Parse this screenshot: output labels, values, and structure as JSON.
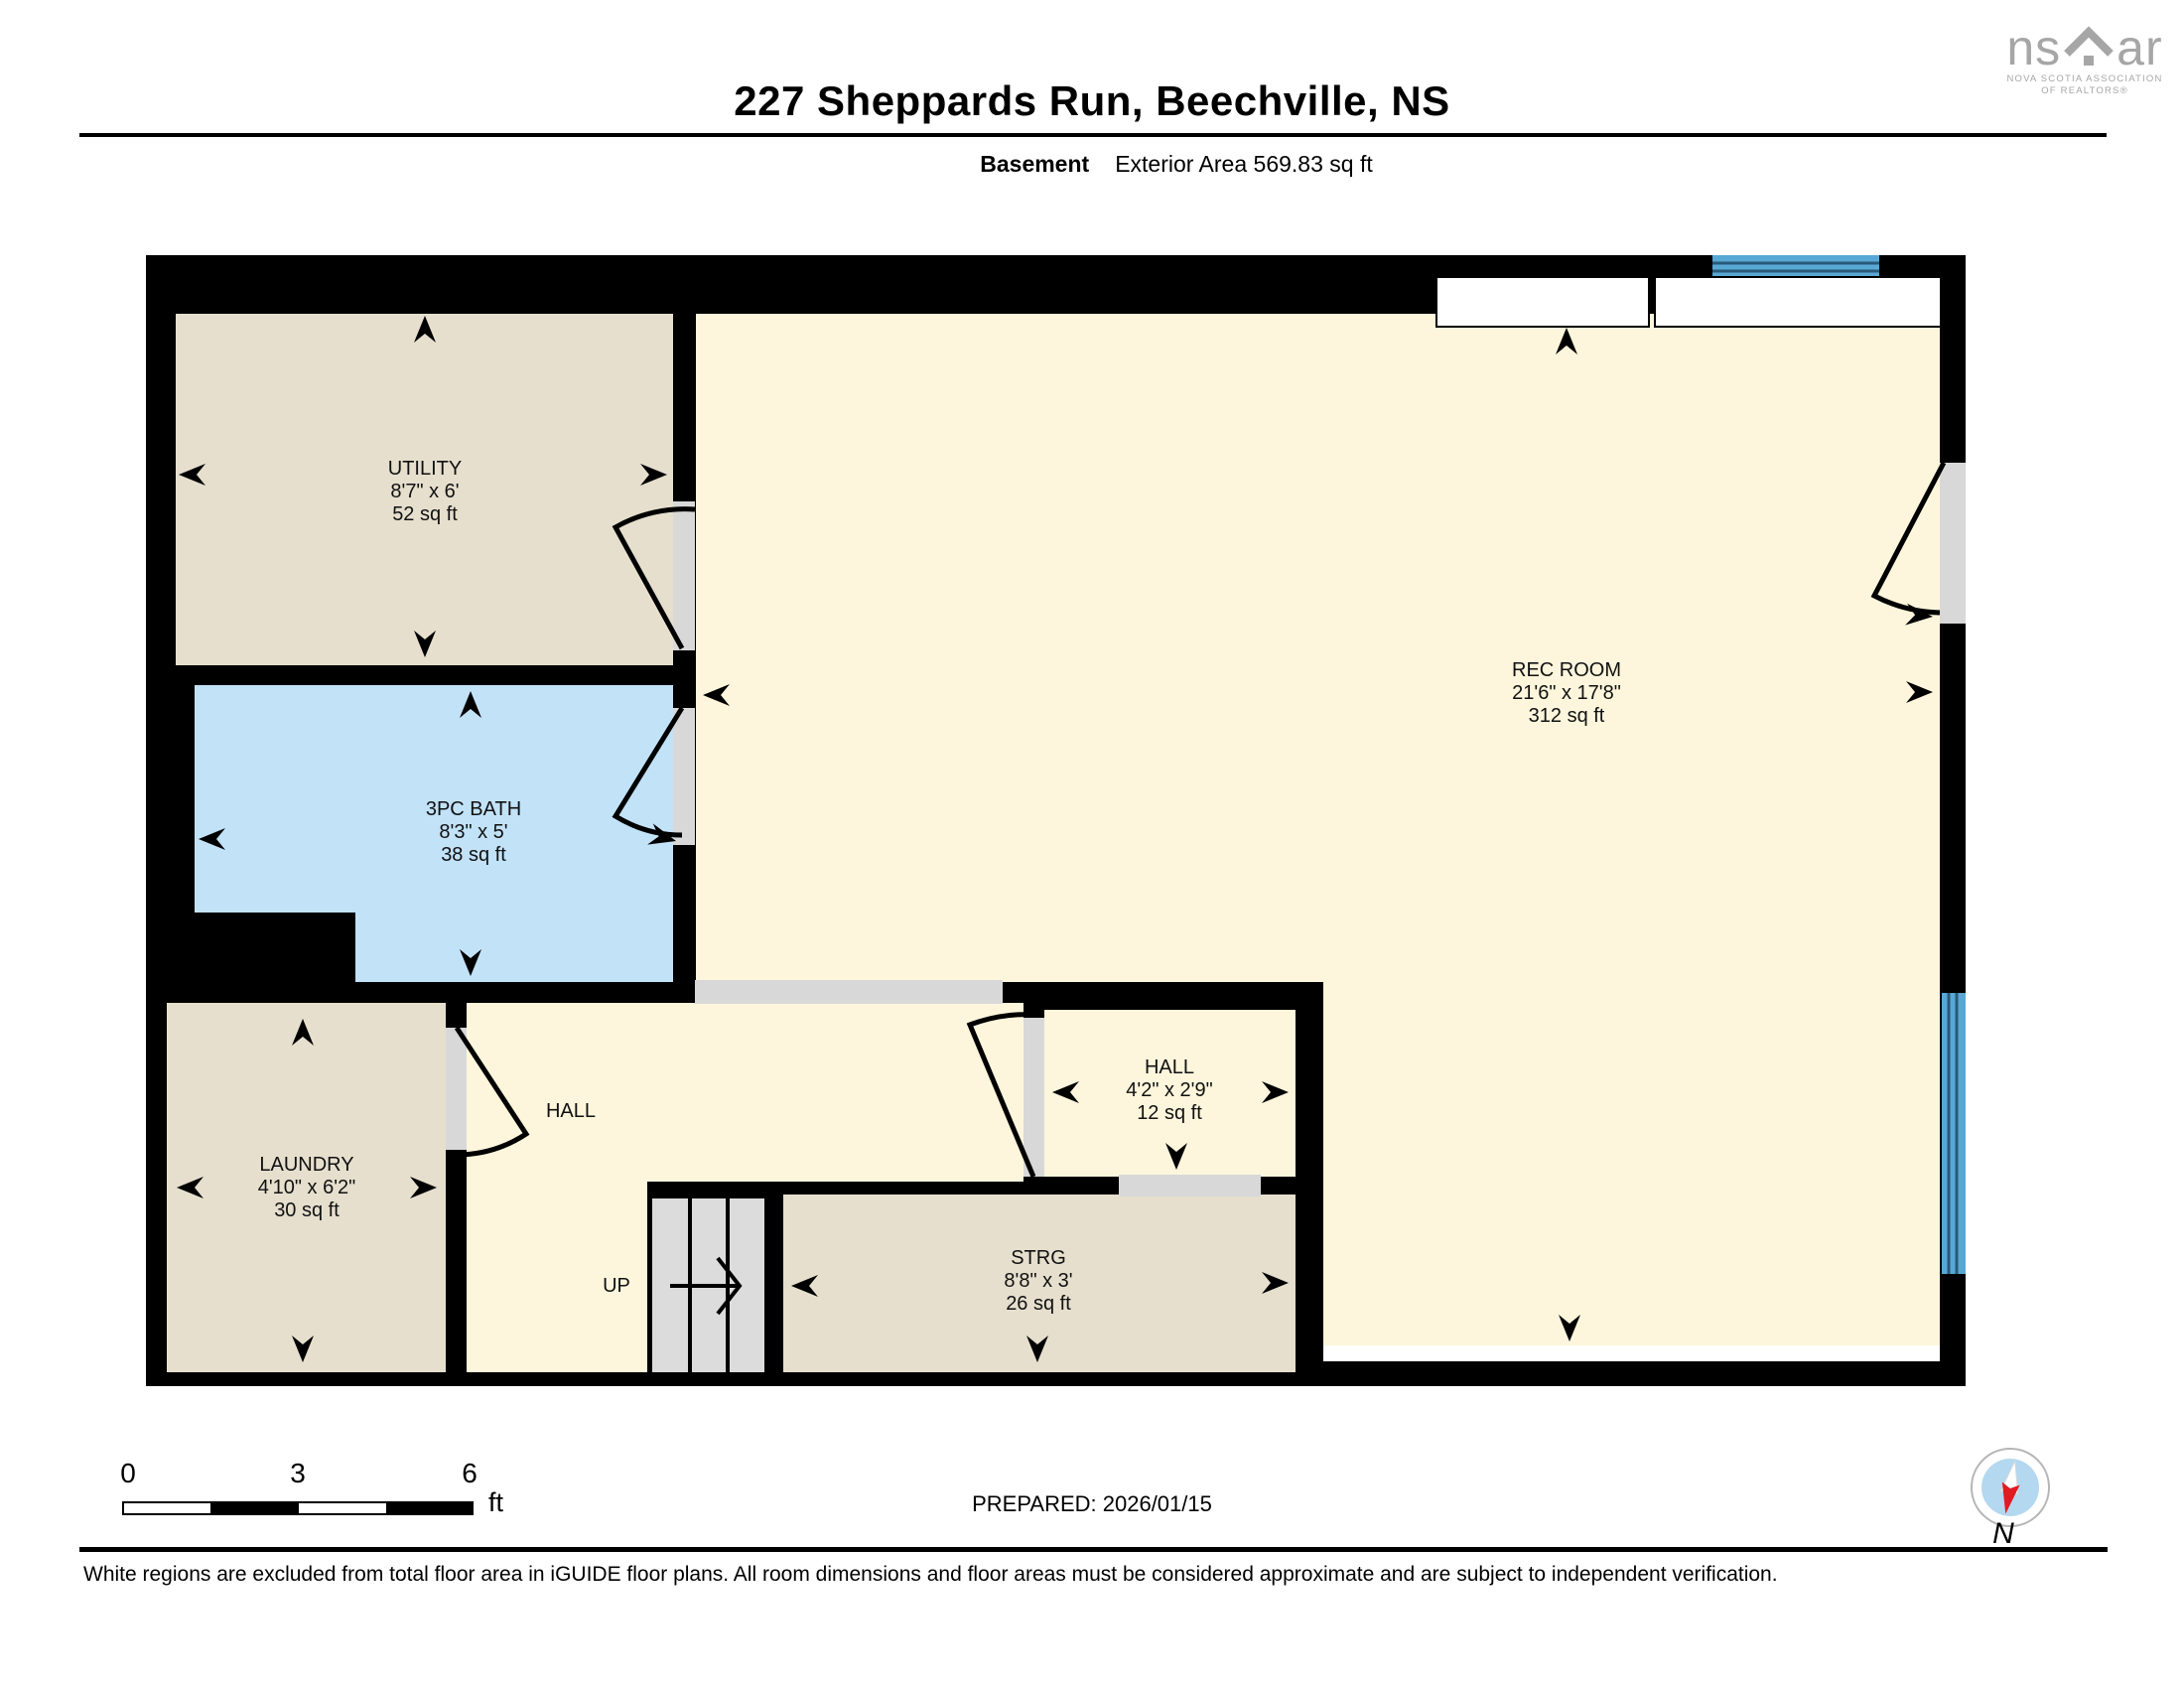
{
  "header": {
    "title": "227 Sheppards Run, Beechville, NS",
    "level_label": "Basement",
    "area_label": "Exterior Area 569.83 sq ft"
  },
  "logo": {
    "brand_left": "ns",
    "brand_right": "ar",
    "tagline1": "NOVA SCOTIA ASSOCIATION",
    "tagline2": "OF REALTORS®"
  },
  "rooms": [
    {
      "name": "UTILITY",
      "dims": "8'7\" x 6'",
      "area": "52 sq ft"
    },
    {
      "name": "3PC BATH",
      "dims": "8'3\" x 5'",
      "area": "38 sq ft"
    },
    {
      "name": "REC ROOM",
      "dims": "21'6\" x 17'8\"",
      "area": "312 sq ft"
    },
    {
      "name": "LAUNDRY",
      "dims": "4'10\" x 6'2\"",
      "area": "30 sq ft"
    },
    {
      "name": "HALL",
      "dims": "",
      "area": ""
    },
    {
      "name": "HALL",
      "dims": "4'2\" x 2'9\"",
      "area": "12 sq ft"
    },
    {
      "name": "STRG",
      "dims": "8'8\" x 3'",
      "area": "26 sq ft"
    }
  ],
  "stairs_label": "UP",
  "scale": {
    "ticks": [
      "0",
      "3",
      "6"
    ],
    "unit": "ft"
  },
  "prepared_label": "PREPARED: 2026/01/15",
  "compass_label": "N",
  "disclaimer": "White regions are excluded from total floor area in iGUIDE floor plans. All room dimensions and floor areas must be considered approximate and are subject to independent verification.",
  "colors": {
    "wall": "#000000",
    "room_beige": "#e6dfce",
    "room_cream": "#fdf6dc",
    "room_bath_blue": "#c2e2f8",
    "window_blue": "#58a8d6",
    "opening_gray": "#d8d8d8",
    "logo_gray": "#a6a6a6",
    "compass_blue": "#b3d8f0",
    "compass_red": "#e01b22"
  }
}
